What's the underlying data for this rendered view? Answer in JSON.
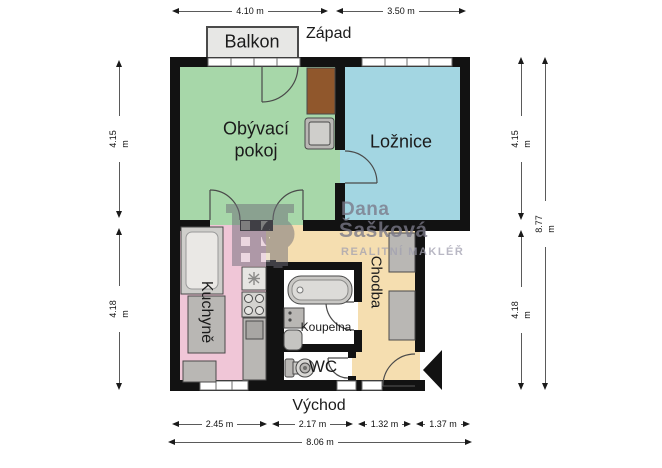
{
  "compass": {
    "west": "Západ",
    "east": "Východ"
  },
  "rooms": {
    "balcony": "Balkon",
    "living": "Obývací pokoj",
    "bedroom": "Ložnice",
    "kitchen": "Kuchyně",
    "hall": "Chodba",
    "bath": "Koupelna",
    "wc": "WC"
  },
  "dimensions": {
    "top": [
      "4.10 m",
      "3.50 m"
    ],
    "left": [
      "4.15 m",
      "4.18 m"
    ],
    "right": [
      "4.15 m",
      "4.18 m"
    ],
    "right_total": "8.77 m",
    "bottom": [
      "2.45 m",
      "2.17 m",
      "1.32 m",
      "1.37 m"
    ],
    "bottom_total": "8.06 m"
  },
  "watermark": {
    "name_line1": "Dana",
    "name_line2": "Šašková",
    "subtitle": "REALITNÍ MAKLÉŘ"
  },
  "icons": {
    "logo": "building-with-magnifier-icon",
    "entrance": "entrance-arrow-icon"
  },
  "colors": {
    "living": "#a7d7a9",
    "bedroom": "#a3d6e2",
    "kitchen": "#f0c6d7",
    "hall": "#f5deb0",
    "bath": "#ffffff",
    "balcony": "#e7e7e5",
    "wall": "#121212",
    "furniture": "#b9b7b4",
    "furniture_light": "#eae8e5",
    "wood": "#90572c",
    "watermark": "#7a7888"
  }
}
